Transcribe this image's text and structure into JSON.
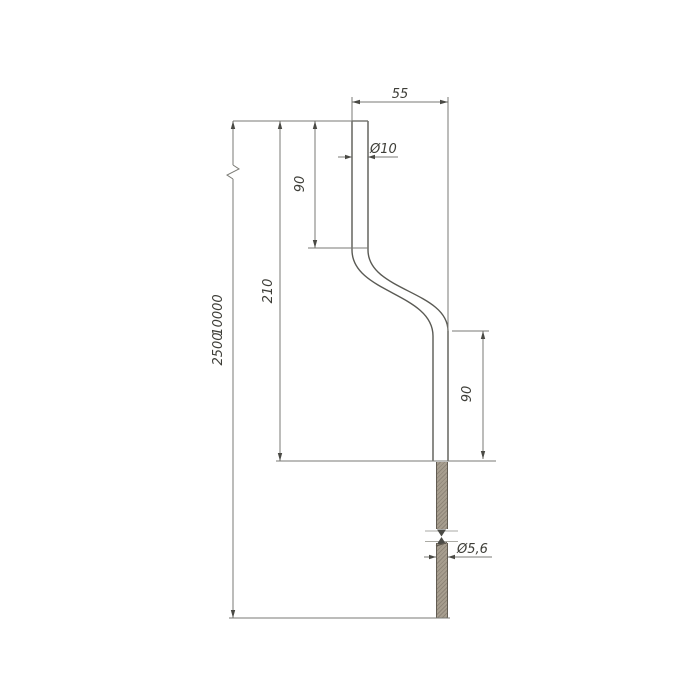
{
  "drawing": {
    "title": "offset-bent-rod-dimension-drawing",
    "labels": {
      "width_top": "55",
      "dia_top": "Ø10",
      "len_upper": "90",
      "len_middle": "210",
      "len_total_lower": "2500",
      "len_total_upper": "10000",
      "len_lower": "90",
      "dia_bottom": "Ø5,6"
    },
    "colors": {
      "background": "#ffffff",
      "dimension_line": "#7a7a74",
      "rod_outline": "#5a5a54",
      "text": "#3e3e38",
      "hatch_base": "#a79e8f",
      "hatch_dark": "#8e8578"
    }
  }
}
